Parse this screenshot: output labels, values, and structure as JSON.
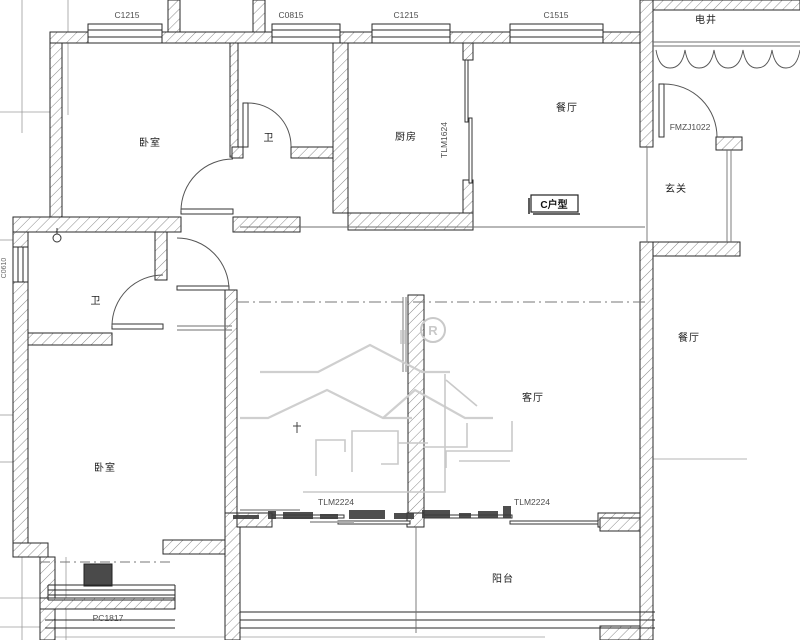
{
  "unit_label": {
    "text": "C户型"
  },
  "rooms": {
    "bedroom_top_left": "卧室",
    "bath_top": "卫",
    "kitchen": "厨房",
    "dining_top": "餐厅",
    "utility_shaft": "电井",
    "entry_hall": "玄关",
    "bath_mid": "卫",
    "bedroom_bottom_left": "卧室",
    "living": "客厅",
    "dining_right": "餐厅",
    "balcony": "阳台"
  },
  "window_codes": {
    "top_1": "C1215",
    "top_2": "C0815",
    "top_3": "C1215",
    "top_4": "C1515",
    "left_small": "C0610",
    "bay_bottom": "PC1817"
  },
  "door_codes": {
    "entrance": "FMZJ1022",
    "kitchen_sliding": "TLM1624",
    "balcony_sliding_left": "TLM2224",
    "balcony_sliding_right": "TLM2224"
  },
  "watermark": {
    "registered": "R"
  },
  "colors": {
    "wall_stroke": "#2a2a2a",
    "hatch_line": "#8a8a8a",
    "grid_line": "#9b9b9b",
    "door_arc": "#555555",
    "label_text": "#1e1e1e",
    "code_text": "#4d4d4d",
    "watermark_gray": "#cccccc",
    "solid_pier": "#4a4a4a"
  }
}
